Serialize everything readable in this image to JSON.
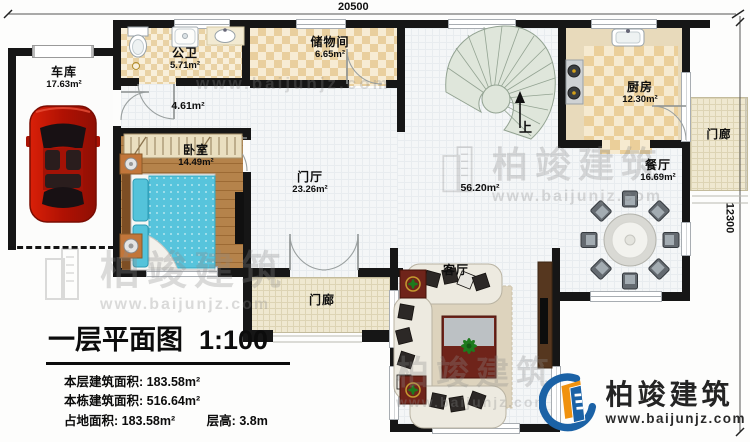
{
  "dimensions": {
    "top": "20500",
    "right": "12300"
  },
  "plan_title": {
    "text": "一层平面图",
    "scale": "1:100"
  },
  "stats": {
    "line1_label": "本层建筑面积:",
    "line1_value": "183.58m²",
    "line2_label": "本栋建筑面积:",
    "line2_value": "516.64m²",
    "line3_label": "占地面积:",
    "line3_value": "183.58m²",
    "line4_label": "层高:",
    "line4_value": "3.8m"
  },
  "rooms": {
    "garage": {
      "name": "车库",
      "area": "17.63m²"
    },
    "bath": {
      "name": "公卫",
      "area": "5.71m²"
    },
    "storage": {
      "name": "储物间",
      "area": "6.65m²"
    },
    "corridor": {
      "area": "4.61m²"
    },
    "bedroom": {
      "name": "卧室",
      "area": "14.49m²"
    },
    "foyer": {
      "name": "门厅",
      "area": "23.26m²"
    },
    "open_area": {
      "area": "56.20m²"
    },
    "kitchen": {
      "name": "厨房",
      "area": "12.30m²"
    },
    "dining": {
      "name": "餐厅",
      "area": "16.69m²"
    },
    "living": {
      "name": "客厅"
    },
    "porch_bottom": {
      "name": "门廊"
    },
    "porch_right": {
      "name": "门廊"
    }
  },
  "stairs": {
    "up_label": "上"
  },
  "branding": {
    "company": "柏竣建筑",
    "website": "www.baijunjz.com"
  },
  "watermark": {
    "company": "柏竣建筑",
    "website": "www.baijunjz.com"
  },
  "colors": {
    "accent_blue": "#1b62a6",
    "accent_orange": "#f0920f",
    "wall": "#161616"
  }
}
